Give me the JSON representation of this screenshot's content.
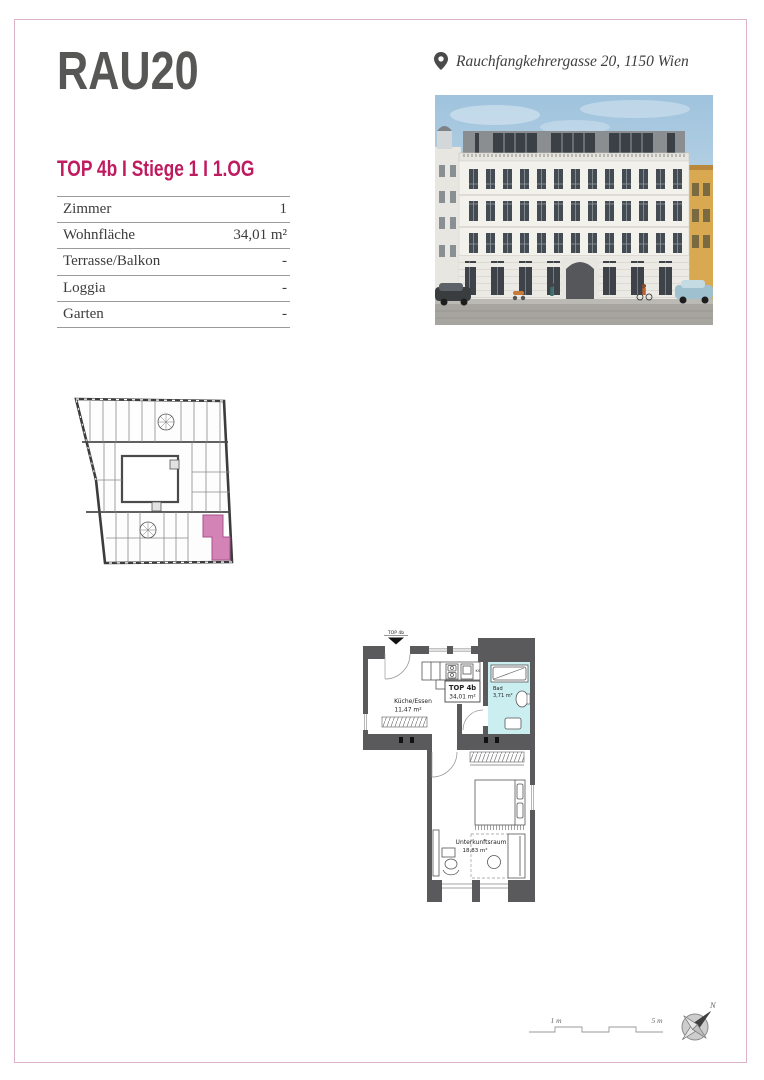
{
  "brand": {
    "logo": "RAU20"
  },
  "header": {
    "unit_title": "TOP 4b I Stiege 1 I 1.OG"
  },
  "location": {
    "address": "Rauchfangkehrergasse 20, 1150 Wien"
  },
  "spec_table": {
    "rows": [
      {
        "label": "Zimmer",
        "value": "1"
      },
      {
        "label": "Wohnfläche",
        "value": "34,01 m²"
      },
      {
        "label": "Terrasse/Balkon",
        "value": "-"
      },
      {
        "label": "Loggia",
        "value": "-"
      },
      {
        "label": "Garten",
        "value": "-"
      }
    ]
  },
  "floor_plan": {
    "entrance_label": "TOP 4b",
    "unit_box": {
      "label": "TOP 4b",
      "area": "34,01 m²"
    },
    "rooms": [
      {
        "name": "Küche/Essen",
        "area": "11,47 m²"
      },
      {
        "name": "Bad",
        "area": "3,71 m²"
      },
      {
        "name": "Unterkunftsraum",
        "area": "18,83 m²"
      }
    ],
    "appliance_label": "KS"
  },
  "scale_bar": {
    "label_1m": "1 m",
    "label_5m": "5 m"
  },
  "compass": {
    "north": "N"
  },
  "colors": {
    "accent": "#bf1b5f",
    "logo_gray": "#575756",
    "highlight_pink": "#d483b6",
    "bad_blue": "#cbeef1",
    "wall_gray": "#5a5a5c",
    "frame_pink": "#dcb3c9"
  }
}
